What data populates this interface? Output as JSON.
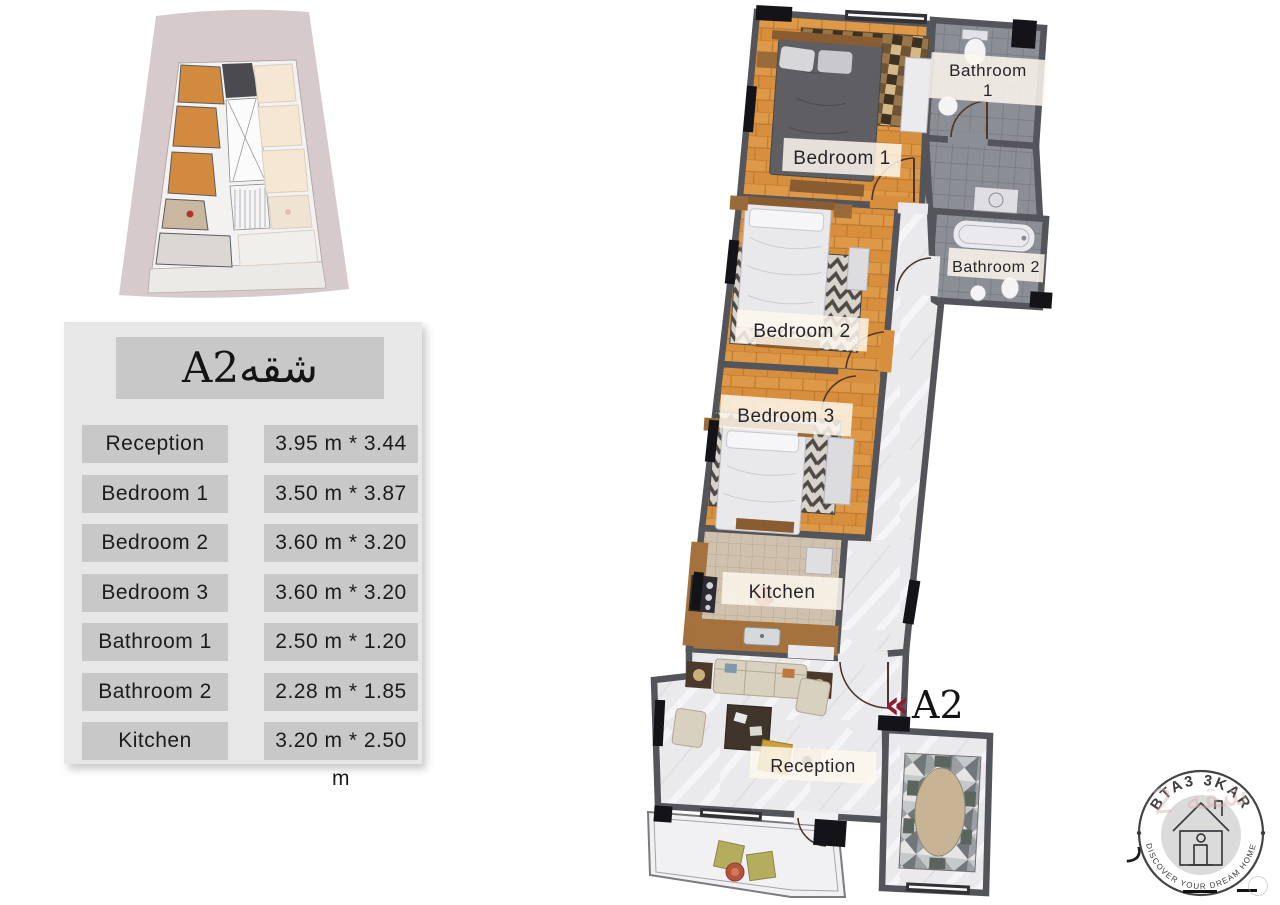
{
  "unit_table": {
    "title": "A2شقه",
    "rows": [
      {
        "room": "Reception",
        "size": "3.95 m * 3.44 m"
      },
      {
        "room": "Bedroom 1",
        "size": "3.50 m * 3.87 m"
      },
      {
        "room": "Bedroom 2",
        "size": "3.60 m * 3.20 m"
      },
      {
        "room": "Bedroom 3",
        "size": "3.60 m * 3.20 m"
      },
      {
        "room": "Bathroom 1",
        "size": "2.50 m * 1.20 m"
      },
      {
        "room": "Bathroom 2",
        "size": "2.28 m * 1.85 m"
      },
      {
        "room": "Kitchen",
        "size": "3.20 m * 2.50 m"
      }
    ]
  },
  "floor_plan": {
    "rooms": {
      "bedroom1": "Bedroom 1",
      "bedroom2": "Bedroom 2",
      "bedroom3": "Bedroom 3",
      "bathroom1_line1": "Bathroom",
      "bathroom1_line2": "1",
      "bathroom2": "Bathroom 2",
      "kitchen": "Kitchen",
      "reception": "Reception"
    },
    "unit_marker": {
      "arrow": "«",
      "label": "A2"
    }
  },
  "logo": {
    "brand": "BTA3 3KAR",
    "tagline": "DISCOVER YOUR DREAM HOME",
    "watermark_text": "شقه 2",
    "watermark_glyph": "ر"
  },
  "colors": {
    "accent_red": "#8e1e2e",
    "wall": "#54555b",
    "parquet": "#d78f3e",
    "table_cell": "#c9c8c9",
    "table_panel": "#e8e7e8",
    "overview_bg": "#d6cacd"
  }
}
